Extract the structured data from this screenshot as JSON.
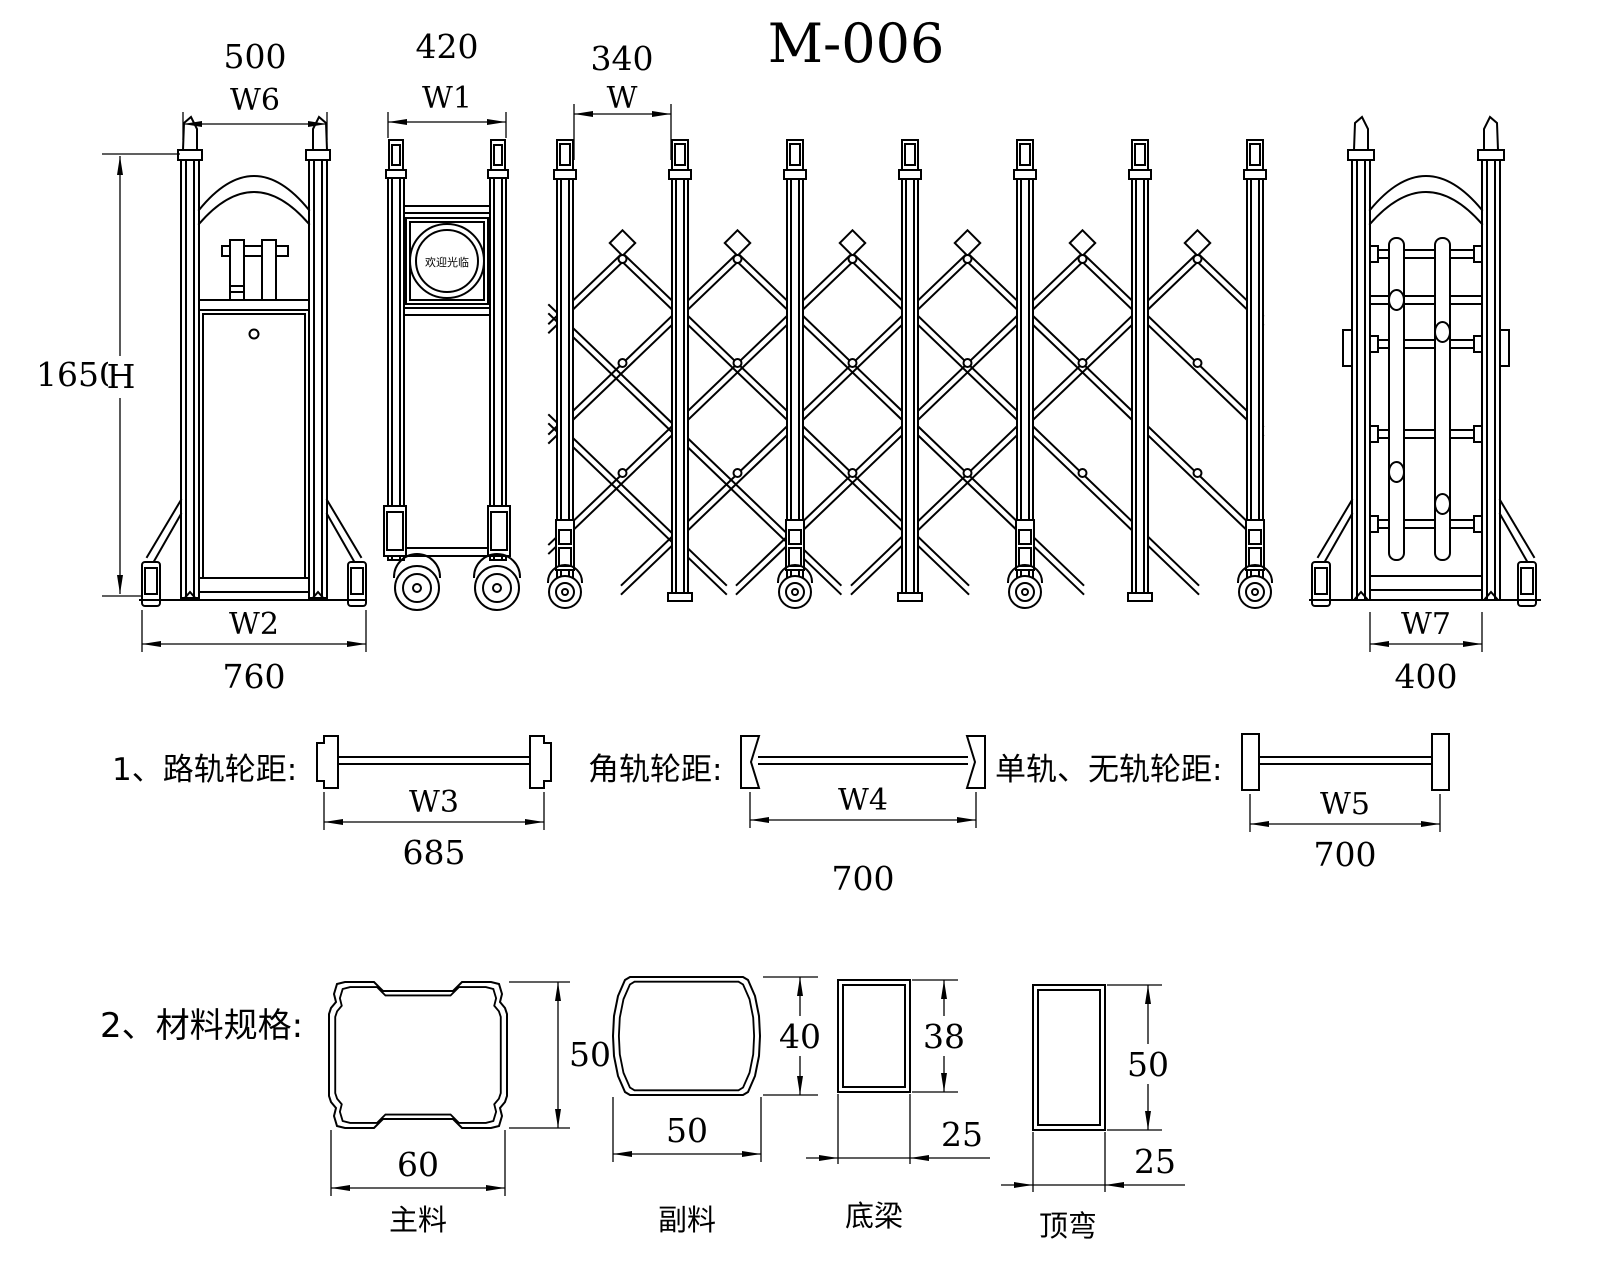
{
  "title": "M-006",
  "sign_text": "欢迎光临",
  "dims": {
    "w6": {
      "value": "500",
      "label": "W6"
    },
    "w1": {
      "value": "420",
      "label": "W1"
    },
    "w": {
      "value": "340",
      "label": "W"
    },
    "height": {
      "value": "1650",
      "label": "H"
    },
    "w2": {
      "label": "W2",
      "value": "760"
    },
    "w7": {
      "label": "W7",
      "value": "400"
    }
  },
  "tracks": [
    {
      "label": "1、路轨轮距:",
      "dim": "W3",
      "value": "685"
    },
    {
      "label": "角轨轮距:",
      "dim": "W4",
      "value": "700"
    },
    {
      "label": "单轨、无轨轮距:",
      "dim": "W5",
      "value": "700"
    }
  ],
  "materials": {
    "heading": "2、材料规格:",
    "profiles": [
      {
        "name": "主料",
        "width": "60",
        "height": "50"
      },
      {
        "name": "副料",
        "width": "50",
        "height": "40"
      },
      {
        "name": "底梁",
        "width": "25",
        "height": "38"
      },
      {
        "name": "顶弯",
        "width": "25",
        "height": "50"
      }
    ]
  }
}
